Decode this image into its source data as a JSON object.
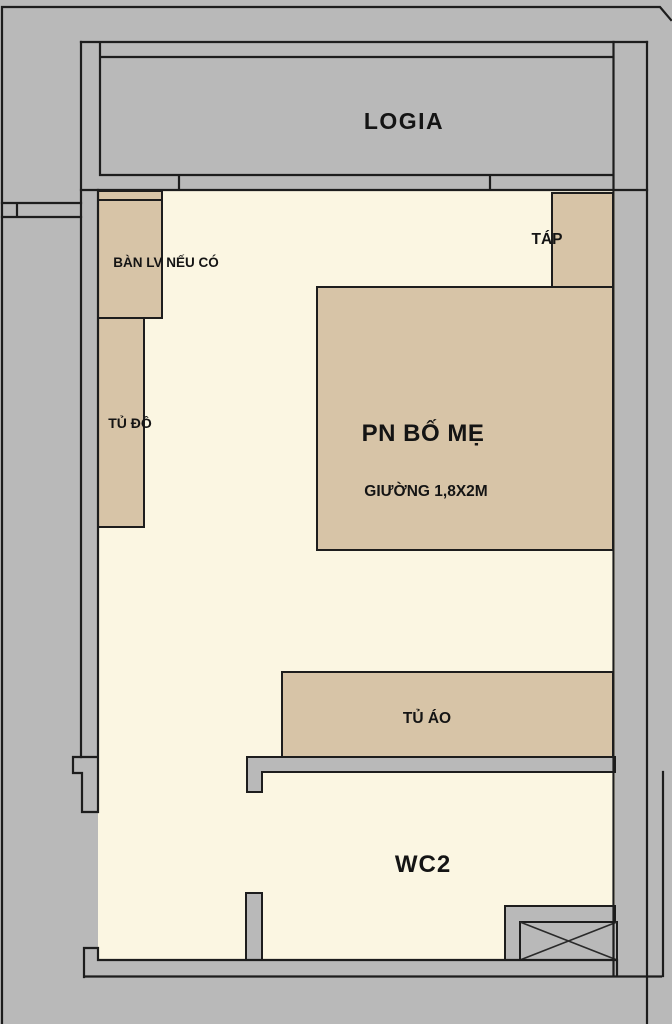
{
  "colors": {
    "background": "#b9b9b9",
    "floor": "#fbf6e2",
    "furniture": "#d7c4a7",
    "outline": "#1d1d1d"
  },
  "rooms": {
    "logia": {
      "label": "LOGIA"
    },
    "bedroom": {
      "label": "PN BỐ MẸ"
    },
    "wc": {
      "label": "WC2"
    }
  },
  "furniture": {
    "desk": {
      "label": "BÀN LV NẾU CÓ"
    },
    "closet": {
      "label": "TỦ ĐỒ"
    },
    "nightstand": {
      "label": "TÁP"
    },
    "bed": {
      "label": "GIƯỜNG 1,8X2M"
    },
    "wardrobe": {
      "label": "TỦ ÁO"
    }
  }
}
